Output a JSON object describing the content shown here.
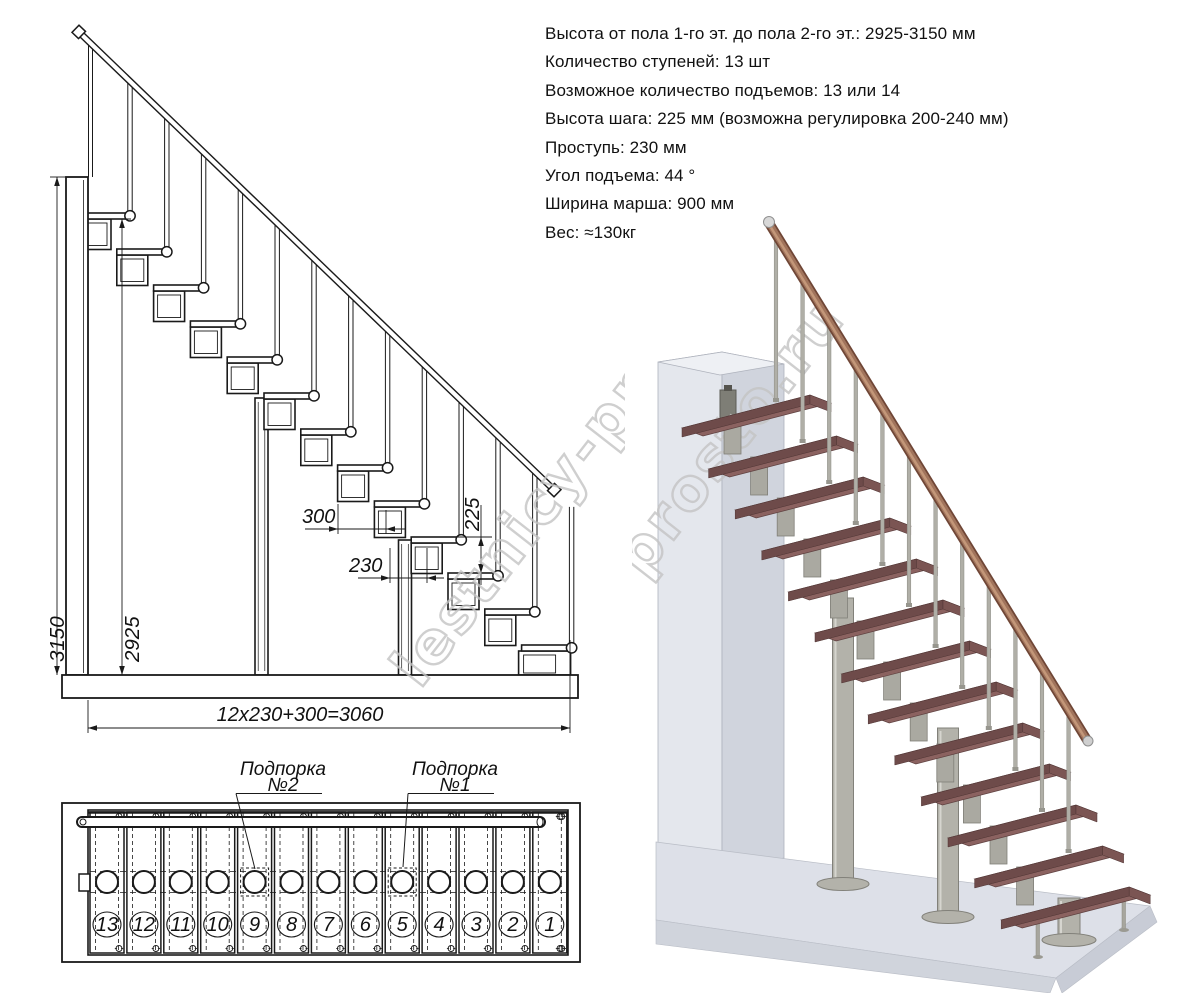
{
  "specs": {
    "lines": [
      "Высота от пола 1-го эт. до пола 2-го эт.: 2925-3150 мм",
      "Количество ступеней: 13 шт",
      "Возможное количество подъемов: 13 или 14",
      "Высота шага: 225 мм (возможна регулировка 200-240 мм)",
      "Проступь: 230 мм",
      "Угол подъема: 44 °",
      "Ширина марша: 900 мм",
      "Вес: ≈130кг"
    ]
  },
  "elevation": {
    "step_count": 13,
    "dims": {
      "total_height": "3150",
      "flight_height": "2925",
      "module_pitch": "300",
      "going": "230",
      "rise": "225",
      "total_length": "12x230+300=3060"
    }
  },
  "plan": {
    "step_numbers": [
      "13",
      "12",
      "11",
      "10",
      "9",
      "8",
      "7",
      "6",
      "5",
      "4",
      "3",
      "2",
      "1"
    ],
    "support_indices": [
      4,
      8
    ],
    "callouts": [
      {
        "line1": "Подпорка",
        "line2": "№2"
      },
      {
        "line1": "Подпорка",
        "line2": "№1"
      }
    ]
  },
  "watermark": {
    "text": "lestnicy-prosto.ru"
  },
  "colors": {
    "line": "#1a1a1a",
    "tread_top": "#8b6260",
    "tread_front": "#6e4b4a",
    "tread_side": "#7b5553",
    "handrail_dark": "#6f4636",
    "handrail_mid": "#a1745c",
    "handrail_light": "#c79b7d",
    "metal": "#b3b2aa",
    "metal_edge": "#82817a",
    "wall_light": "#e4e7ed",
    "wall_front": "#d0d4dd",
    "floor_top": "#dde0e8",
    "floor_front": "#d0d4dc",
    "floor_side": "#c8ccd6",
    "watermark": "#c4c4c4"
  }
}
